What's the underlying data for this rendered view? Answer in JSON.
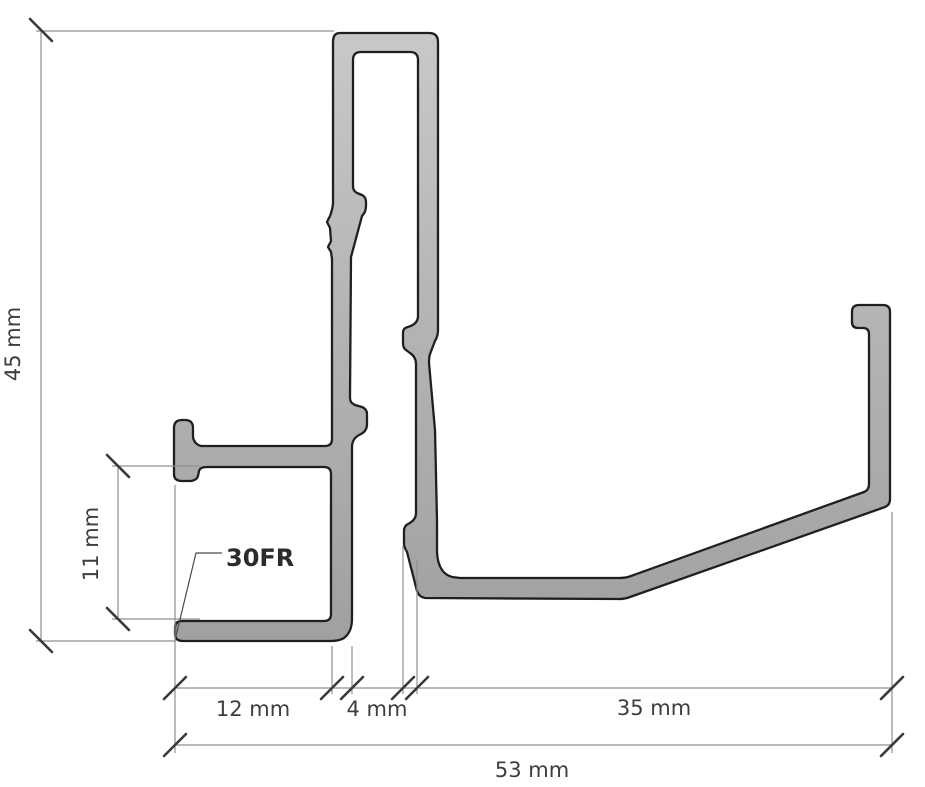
{
  "drawing": {
    "profile_label": "30FR",
    "unit": "mm",
    "dimensions": {
      "overall_height": "45 mm",
      "pocket_height": "11 mm",
      "pocket_width": "12 mm",
      "gap_width": "4 mm",
      "base_width": "35 mm",
      "overall_width": "53 mm"
    },
    "colors": {
      "background": "#ffffff",
      "profile_fill_light": "#c7c9c9",
      "profile_fill_mid": "#b2b4b4",
      "profile_fill_dark": "#9fa1a1",
      "profile_outline": "#1f1f1f",
      "dimension_line": "#8f8f8f",
      "tick": "#3a3a3a",
      "dimension_text": "#3d3d3d",
      "label_text": "#2b2b2b"
    }
  }
}
